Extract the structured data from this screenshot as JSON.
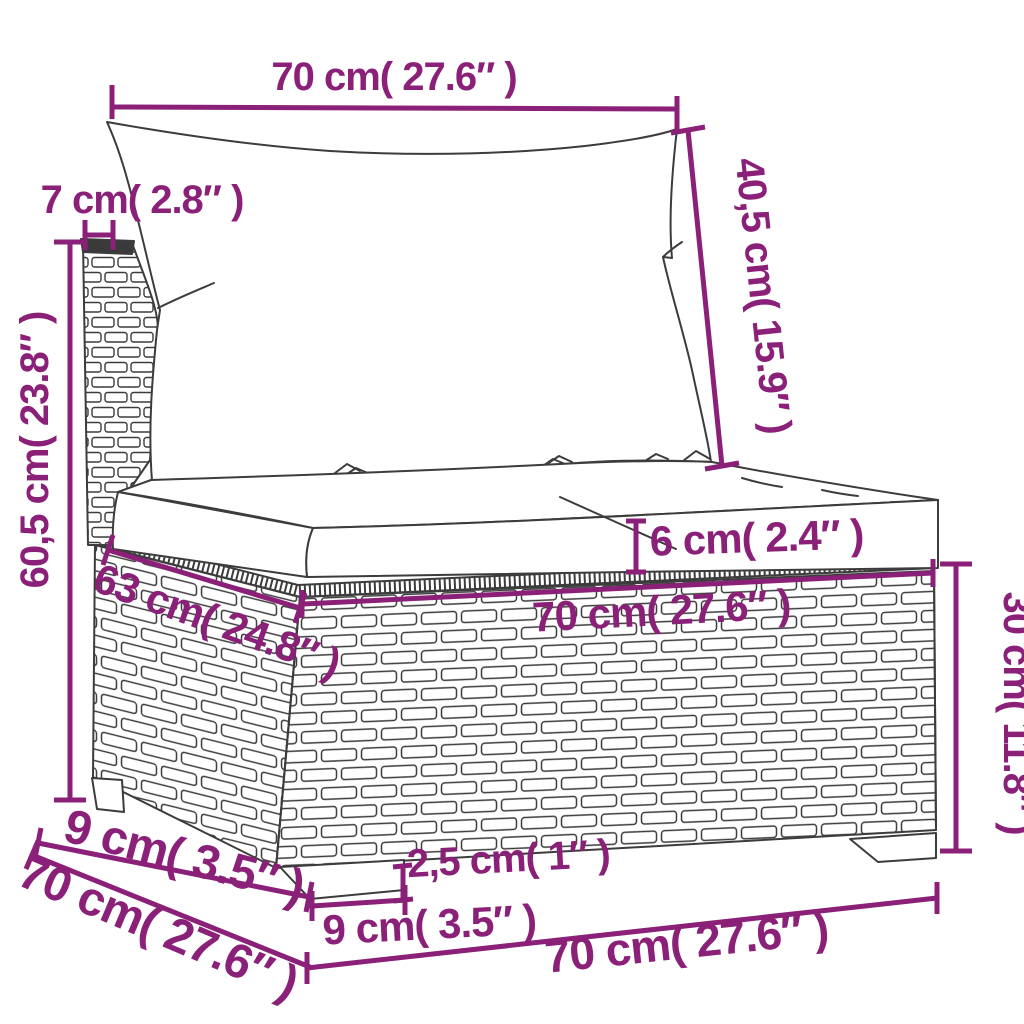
{
  "figure": {
    "type": "product-dimension-diagram",
    "subject": "poly rattan garden sofa middle section with back and seat cushions",
    "background": "#FFFFFF"
  },
  "colors": {
    "dimension_accent": "#8B2078",
    "line_art": "#3C3C3C"
  },
  "dimensions": {
    "top_width": {
      "text": "70 cm( 27.6″ )"
    },
    "backrest_thickness": {
      "text": "7 cm( 2.8″ )"
    },
    "back_cushion_height": {
      "text": "40,5 cm( 15.9″ )"
    },
    "total_height": {
      "text": "60,5 cm( 23.8″ )"
    },
    "seat_cushion_thickness": {
      "text": "6 cm( 2.4″ )"
    },
    "seat_depth": {
      "text": "63 cm( 24.8″ )"
    },
    "seat_width": {
      "text": "70 cm( 27.6″ )"
    },
    "base_height": {
      "text": "30 cm( 11.8″ )"
    },
    "leg_inset_depth": {
      "text": "9 cm( 3.5″ )"
    },
    "total_depth": {
      "text": "70 cm( 27.6″ )"
    },
    "leg_height": {
      "text": "2,5 cm( 1″ )"
    },
    "leg_width": {
      "text": "9 cm( 3.5″ )"
    },
    "bottom_width": {
      "text": "70 cm( 27.6″ )"
    }
  }
}
